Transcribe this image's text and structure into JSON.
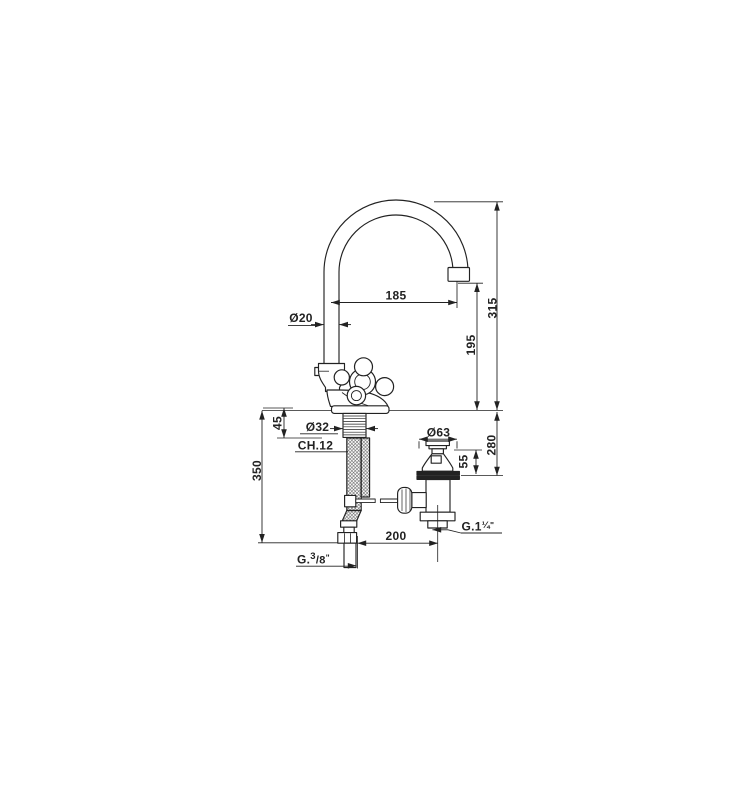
{
  "drawing": {
    "description": "Technical dimension drawing of a single-hole basin mixer tap with swan-neck spout, cross handle, flexible supply hose and pop-up waste",
    "dims": {
      "spout_reach": "185",
      "spout_tube_dia": "Ø20",
      "overall_height": "315",
      "outlet_height": "195",
      "deck_clamp": "45",
      "shank_dia": "Ø32",
      "wrench": "CH.12",
      "hose_drop": "350",
      "waste_cap_dia": "Ø63",
      "waste_height": "55",
      "waste_drop": "280",
      "rod_offset": "200"
    },
    "threads": {
      "supply_prefix": "G.",
      "supply_num": "3",
      "supply_den": "/8",
      "supply_quote": "\"",
      "waste_main": "G.1",
      "waste_frac": "¼",
      "waste_quote": "\""
    }
  }
}
